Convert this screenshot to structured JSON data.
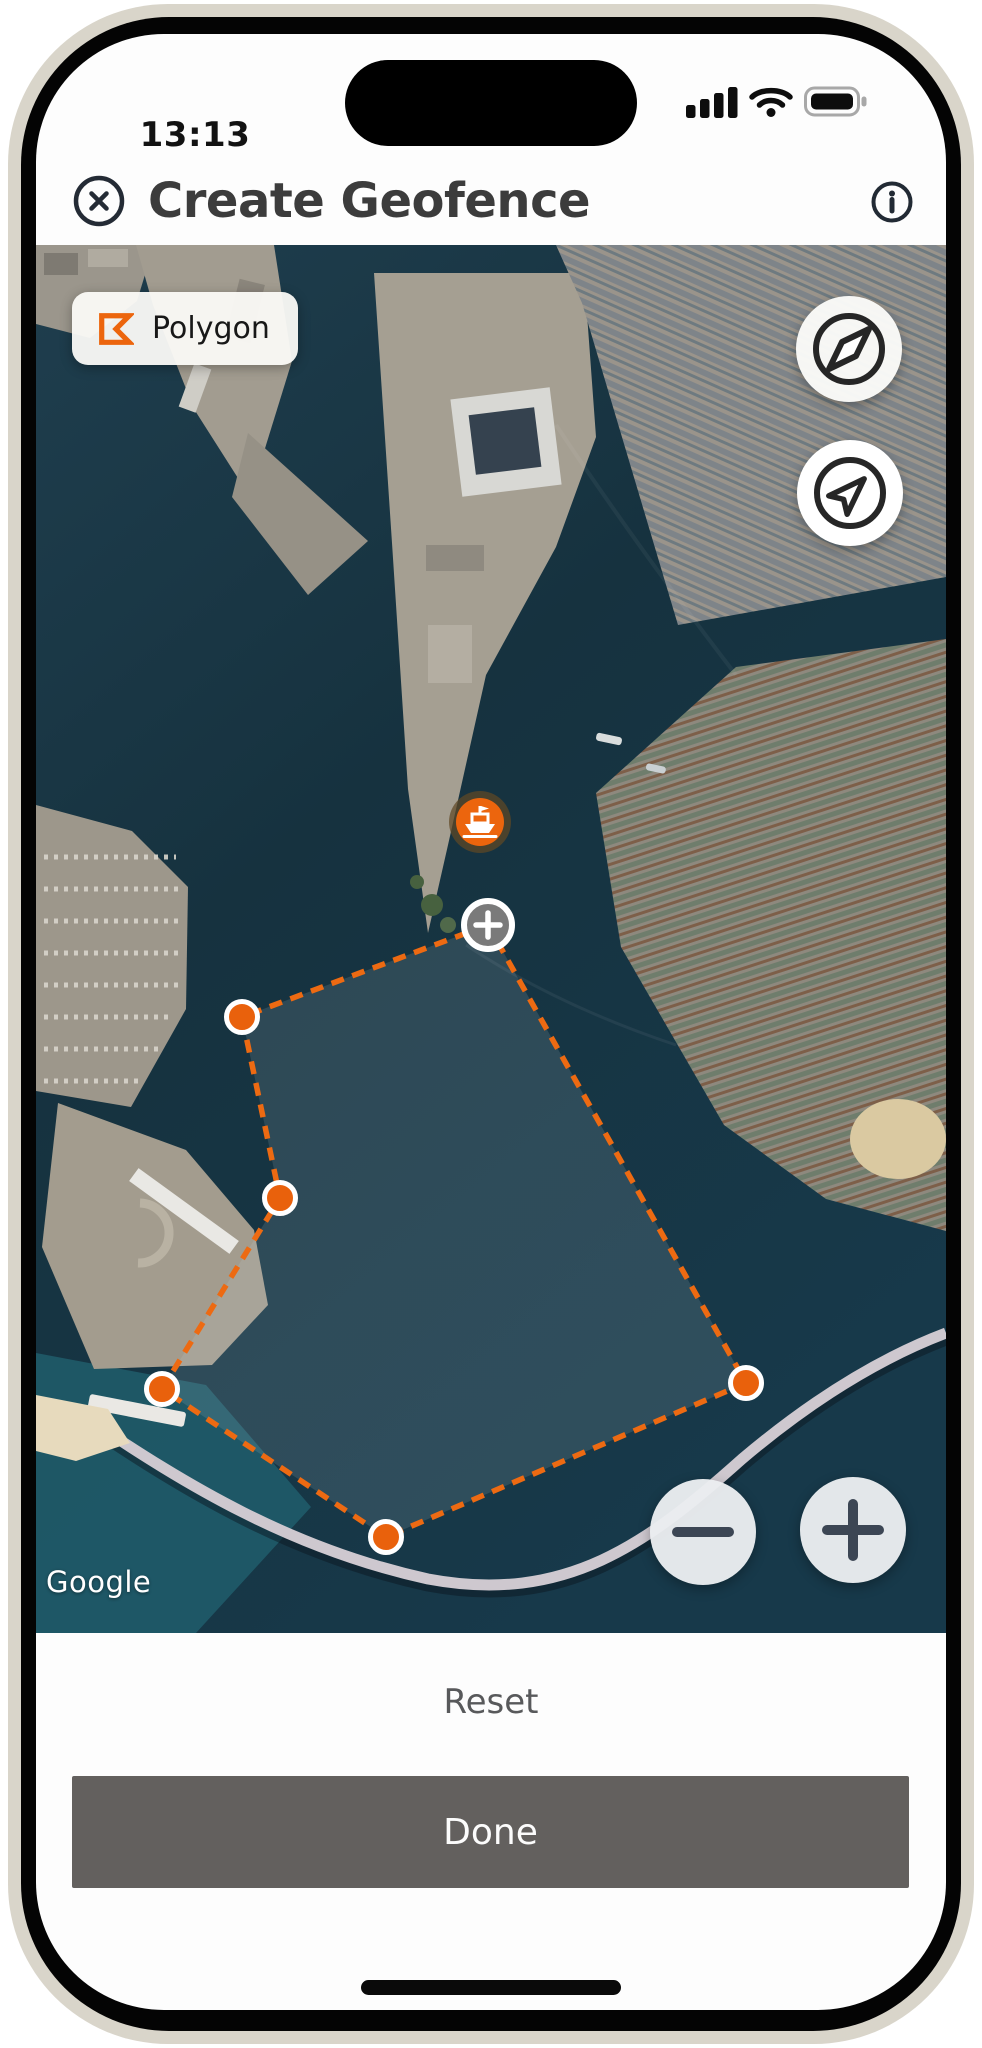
{
  "status_bar": {
    "time": "13:13",
    "icons": [
      "cellular-signal-icon",
      "wifi-icon",
      "battery-icon"
    ]
  },
  "header": {
    "title": "Create Geofence",
    "close_icon": "close-circle-icon",
    "info_icon": "info-circle-icon"
  },
  "map": {
    "provider_attribution": "Google",
    "drawing_mode_chip": {
      "icon": "polygon-outline-icon",
      "label": "Polygon"
    },
    "controls": {
      "compass": "compass-icon",
      "my_location": "navigation-arrow-icon",
      "zoom_out": "minus-icon",
      "zoom_in": "plus-icon"
    },
    "vessel_marker": {
      "icon": "ship-icon",
      "x": 444,
      "y": 577
    },
    "geofence": {
      "add_vertex_marker": {
        "icon": "plus-icon",
        "x": 452,
        "y": 680
      },
      "vertices": [
        {
          "x": 206,
          "y": 772
        },
        {
          "x": 244,
          "y": 953
        },
        {
          "x": 126,
          "y": 1144
        },
        {
          "x": 350,
          "y": 1292
        },
        {
          "x": 710,
          "y": 1138
        }
      ]
    }
  },
  "footer": {
    "reset_label": "Reset",
    "done_label": "Done"
  },
  "colors": {
    "accent_orange": "#EC650D",
    "geofence_stroke": "#ED6A12",
    "geofence_fill": "rgba(198,210,222,0.14)",
    "vertex_fill": "#E9610C",
    "add_marker_fill": "#7A7A7A",
    "vessel_ring": "rgba(96,72,36,0.72)",
    "done_button_bg": "#63605E",
    "reset_text": "#58595B"
  }
}
